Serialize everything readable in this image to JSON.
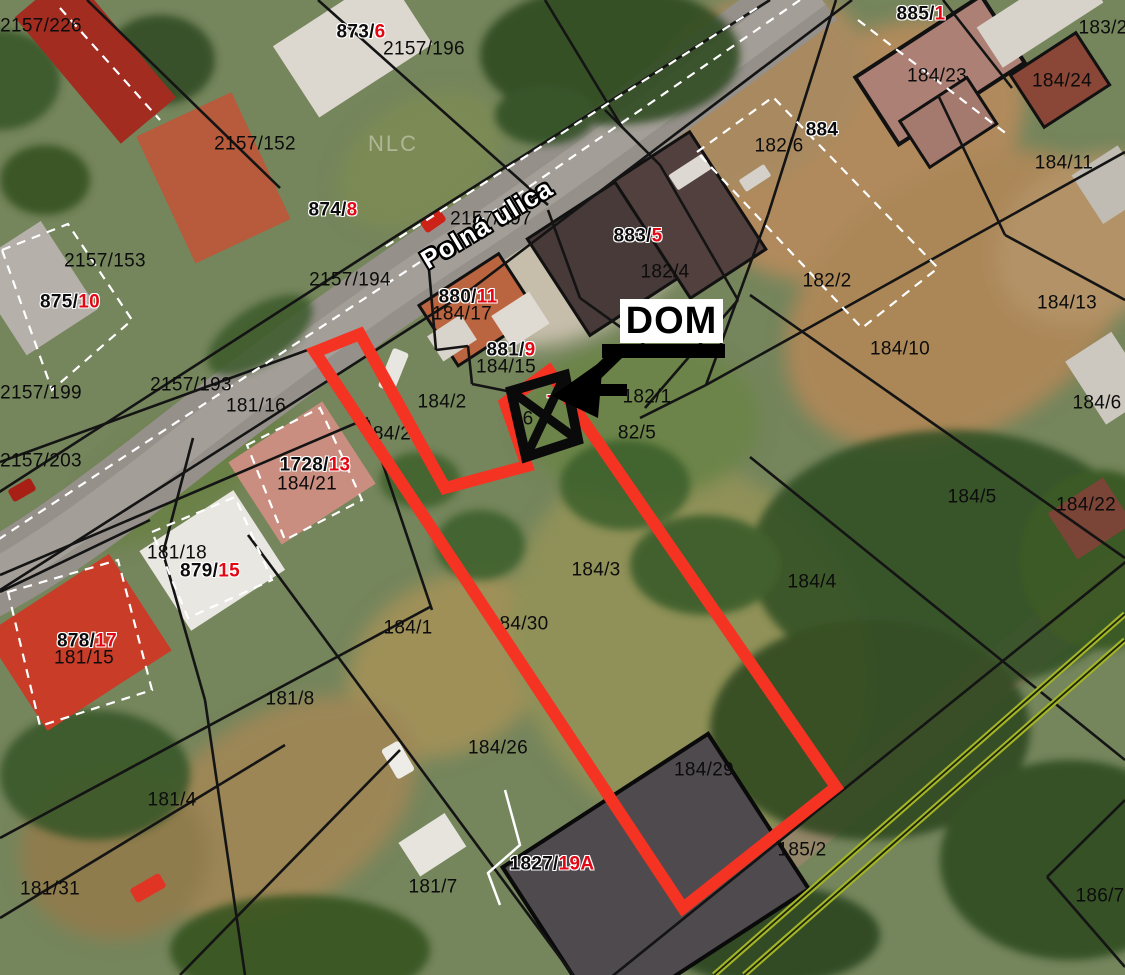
{
  "map": {
    "street_name": "Polná ulica",
    "street_label": {
      "x": 487,
      "y": 224
    },
    "watermark": {
      "text": "NLC",
      "x": 393,
      "y": 144
    },
    "dom_annotation": {
      "label": "DOM",
      "box": [
        620,
        299,
        103,
        44
      ],
      "bar": [
        602,
        344,
        123,
        14
      ],
      "shaft": [
        622,
        349,
        588,
        382
      ],
      "head": [
        [
          552,
          396
        ],
        [
          603,
          360
        ],
        [
          598,
          418
        ]
      ],
      "tail": [
        590,
        390,
        627,
        390
      ]
    },
    "colors": {
      "highlight": "#f43322",
      "label_black": "#0c0c0c",
      "label_red": "#e30613",
      "boundary": "#141414",
      "white_line": "#ffffff",
      "utility_green": "#a2b427",
      "track_tan": "#97866a",
      "marker_black": "#0a0a0a"
    },
    "parcel_labels": [
      {
        "t": "2157/226",
        "x": 41,
        "y": 26
      },
      {
        "t": "873/",
        "r": "6",
        "x": 361,
        "y": 32,
        "halo": true
      },
      {
        "t": "2157/196",
        "x": 424,
        "y": 49
      },
      {
        "t": "885/",
        "r": "1",
        "x": 921,
        "y": 14,
        "halo": true
      },
      {
        "t": "183/2",
        "x": 1103,
        "y": 28
      },
      {
        "t": "184/23",
        "x": 937,
        "y": 76
      },
      {
        "t": "184/24",
        "x": 1062,
        "y": 81
      },
      {
        "t": "2157/152",
        "x": 255,
        "y": 144
      },
      {
        "t": "184/11",
        "x": 1064,
        "y": 163
      },
      {
        "t": "182/6",
        "x": 779,
        "y": 146
      },
      {
        "t": "884",
        "x": 822,
        "y": 130,
        "halo": true
      },
      {
        "t": "874/",
        "r": "8",
        "x": 333,
        "y": 210,
        "halo": true
      },
      {
        "t": "2157/197",
        "x": 491,
        "y": 219
      },
      {
        "t": "883/",
        "r": "5",
        "x": 638,
        "y": 236,
        "halo": true
      },
      {
        "t": "2157/153",
        "x": 105,
        "y": 261
      },
      {
        "t": "182/4",
        "x": 665,
        "y": 272
      },
      {
        "t": "182/2",
        "x": 827,
        "y": 281
      },
      {
        "t": "875/",
        "r": "10",
        "x": 70,
        "y": 302,
        "halo": true
      },
      {
        "t": "2157/194",
        "x": 350,
        "y": 280
      },
      {
        "t": "880/",
        "r": "11",
        "x": 468,
        "y": 297,
        "halo": true
      },
      {
        "t": "184/17",
        "x": 462,
        "y": 314
      },
      {
        "t": "881/",
        "r": "9",
        "x": 511,
        "y": 350,
        "halo": true
      },
      {
        "t": "184/15",
        "x": 506,
        "y": 367
      },
      {
        "t": "184/10",
        "x": 900,
        "y": 349
      },
      {
        "t": "2157/193",
        "x": 191,
        "y": 385
      },
      {
        "t": "184/13",
        "x": 1067,
        "y": 303
      },
      {
        "t": "181/16",
        "x": 256,
        "y": 406
      },
      {
        "t": "184/2",
        "x": 442,
        "y": 402
      },
      {
        "t": "84/2",
        "x": 392,
        "y": 434
      },
      {
        "t": "182/1",
        "x": 647,
        "y": 397
      },
      {
        "t": "",
        "r": "7",
        "x": 552,
        "y": 403,
        "halo": true
      },
      {
        "t": "6",
        "x": 528,
        "y": 419
      },
      {
        "t": "82/5",
        "x": 637,
        "y": 433
      },
      {
        "t": "2157/199",
        "x": 41,
        "y": 393
      },
      {
        "t": "2157/203",
        "x": 41,
        "y": 461
      },
      {
        "t": "1728/",
        "r": "13",
        "x": 315,
        "y": 465,
        "halo": true
      },
      {
        "t": "184/21",
        "x": 307,
        "y": 484
      },
      {
        "t": "184/6",
        "x": 1097,
        "y": 403
      },
      {
        "t": "184/5",
        "x": 972,
        "y": 497
      },
      {
        "t": "184/22",
        "x": 1086,
        "y": 505
      },
      {
        "t": "181/18",
        "x": 177,
        "y": 553
      },
      {
        "t": "879/",
        "r": "15",
        "x": 210,
        "y": 571,
        "halo": true
      },
      {
        "t": "184/3",
        "x": 596,
        "y": 570
      },
      {
        "t": "184/4",
        "x": 812,
        "y": 582
      },
      {
        "t": "878/",
        "r": "17",
        "x": 87,
        "y": 641,
        "halo": true
      },
      {
        "t": "181/15",
        "x": 84,
        "y": 658
      },
      {
        "t": "184/1",
        "x": 408,
        "y": 628
      },
      {
        "t": "84/30",
        "x": 524,
        "y": 624
      },
      {
        "t": "181/8",
        "x": 290,
        "y": 699
      },
      {
        "t": "184/26",
        "x": 498,
        "y": 748
      },
      {
        "t": "184/29",
        "x": 704,
        "y": 770
      },
      {
        "t": "181/4",
        "x": 172,
        "y": 800
      },
      {
        "t": "185/2",
        "x": 802,
        "y": 850
      },
      {
        "t": "181/31",
        "x": 50,
        "y": 889
      },
      {
        "t": "181/7",
        "x": 433,
        "y": 887
      },
      {
        "t": "1827/",
        "r": "19A",
        "x": 552,
        "y": 864,
        "halo": true
      },
      {
        "t": "186/7",
        "x": 1100,
        "y": 896
      }
    ],
    "highlight_outline": [
      [
        315,
        352
      ],
      [
        360,
        334
      ],
      [
        445,
        488
      ],
      [
        527,
        466
      ],
      [
        505,
        403
      ],
      [
        549,
        371
      ],
      [
        836,
        787
      ],
      [
        683,
        908
      ]
    ],
    "house_marker": [
      [
        511,
        391
      ],
      [
        565,
        375
      ],
      [
        578,
        440
      ],
      [
        526,
        457
      ]
    ],
    "boundaries": [
      [
        87,
        0,
        280,
        188
      ],
      [
        318,
        0,
        548,
        205
      ],
      [
        545,
        0,
        622,
        127
      ],
      [
        770,
        0,
        390,
        240
      ],
      [
        390,
        240,
        -10,
        498
      ],
      [
        852,
        0,
        470,
        290
      ],
      [
        470,
        290,
        0,
        590
      ],
      [
        335,
        340,
        0,
        462
      ],
      [
        368,
        418,
        0,
        575
      ],
      [
        150,
        520,
        0,
        592
      ],
      [
        193,
        438,
        163,
        553
      ],
      [
        163,
        553,
        205,
        700
      ],
      [
        205,
        700,
        245,
        975
      ],
      [
        430,
        607,
        0,
        838
      ],
      [
        285,
        745,
        0,
        918
      ],
      [
        400,
        750,
        180,
        975
      ],
      [
        248,
        535,
        573,
        975
      ],
      [
        368,
        420,
        432,
        610
      ],
      [
        428,
        258,
        436,
        350
      ],
      [
        436,
        350,
        468,
        346
      ],
      [
        468,
        346,
        472,
        384
      ],
      [
        472,
        384,
        512,
        392
      ],
      [
        548,
        210,
        580,
        298
      ],
      [
        580,
        298,
        644,
        344
      ],
      [
        605,
        110,
        660,
        165
      ],
      [
        660,
        165,
        738,
        300
      ],
      [
        738,
        300,
        645,
        408
      ],
      [
        836,
        0,
        768,
        215
      ],
      [
        768,
        215,
        706,
        385
      ],
      [
        706,
        385,
        1125,
        152
      ],
      [
        640,
        418,
        706,
        385
      ],
      [
        750,
        295,
        1125,
        558
      ],
      [
        750,
        457,
        1125,
        760
      ],
      [
        938,
        95,
        1005,
        235
      ],
      [
        1005,
        235,
        1125,
        300
      ],
      [
        943,
        0,
        1012,
        88
      ],
      [
        610,
        978,
        1128,
        560
      ],
      [
        1047,
        877,
        1125,
        967
      ],
      [
        1047,
        877,
        1125,
        800
      ]
    ],
    "white_dashed_lines": [
      [
        800,
        0,
        420,
        262
      ],
      [
        420,
        262,
        -10,
        545
      ],
      [
        757,
        8,
        380,
        250
      ],
      [
        60,
        8,
        160,
        120
      ],
      [
        858,
        20,
        1008,
        135
      ]
    ],
    "white_polys": [
      [
        [
          697,
          152
        ],
        [
          773,
          97
        ],
        [
          938,
          268
        ],
        [
          862,
          328
        ]
      ],
      [
        [
          2,
          250
        ],
        [
          68,
          224
        ],
        [
          132,
          320
        ],
        [
          52,
          390
        ]
      ],
      [
        [
          247,
          445
        ],
        [
          320,
          408
        ],
        [
          362,
          500
        ],
        [
          285,
          540
        ]
      ],
      [
        [
          152,
          532
        ],
        [
          235,
          497
        ],
        [
          272,
          580
        ],
        [
          188,
          618
        ]
      ],
      [
        [
          8,
          592
        ],
        [
          118,
          560
        ],
        [
          152,
          690
        ],
        [
          40,
          726
        ]
      ]
    ],
    "white_polylines": [
      [
        [
          505,
          790
        ],
        [
          520,
          845
        ],
        [
          488,
          873
        ],
        [
          500,
          905
        ]
      ]
    ],
    "utility_lines": [
      [
        1125,
        614,
        714,
        975
      ],
      [
        1125,
        640,
        744,
        975
      ]
    ],
    "track": [
      624,
      980,
      1130,
      566
    ]
  }
}
